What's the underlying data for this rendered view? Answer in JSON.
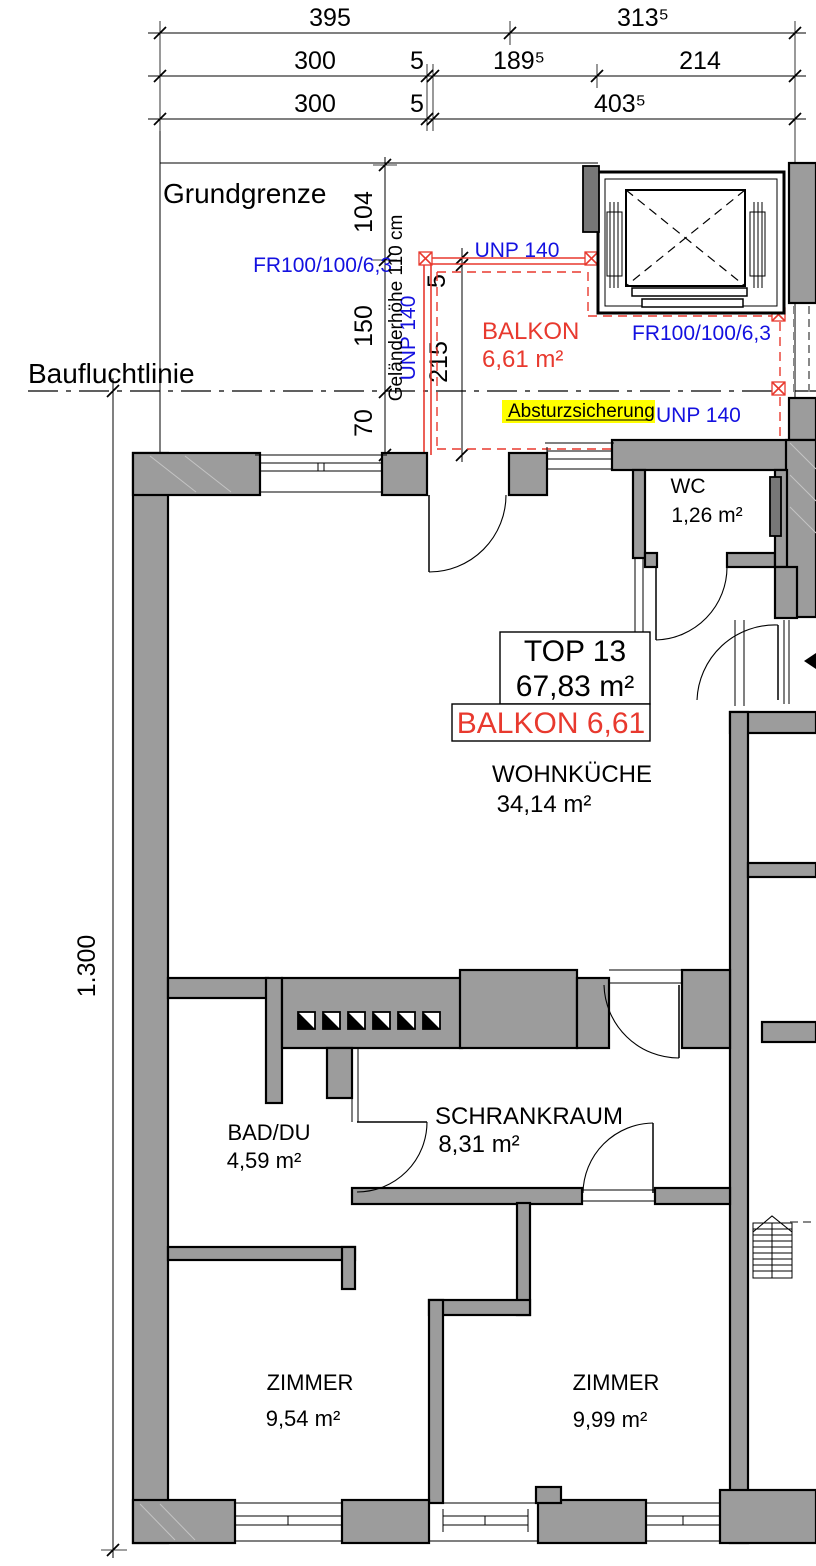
{
  "labels": {
    "grundgrenze": "Grundgrenze",
    "baufluchtlinie": "Baufluchtlinie"
  },
  "dimensions": {
    "top_rows": [
      {
        "segments": [
          "395",
          "313⁵"
        ]
      },
      {
        "segments": [
          "300",
          "5",
          "189⁵",
          "214"
        ]
      },
      {
        "segments": [
          "300",
          "5",
          "403⁵"
        ]
      }
    ],
    "left_vertical": "1.300",
    "right_chain": [
      "104",
      "150",
      "70"
    ],
    "balcony_chain": [
      "5",
      "215"
    ]
  },
  "balcony": {
    "name": "BALKON",
    "area": "6,61 m²",
    "rail_note": "Geländerhöhe 110 cm",
    "unp_top": "UNP 140",
    "unp_left": "UNP 140",
    "unp_bottom": "UNP 140",
    "fr_left": "FR100/100/6,3",
    "fr_right": "FR100/100/6,3",
    "guard": "Absturzsicherung"
  },
  "unit": {
    "id": "TOP 13",
    "area": "67,83 m²",
    "balcony_line": "BALKON 6,61"
  },
  "rooms": {
    "wohnkueche": {
      "name": "WOHNKÜCHE",
      "area": "34,14 m²"
    },
    "wc": {
      "name": "WC",
      "area": "1,26 m²"
    },
    "bad": {
      "name": "BAD/DU",
      "area": "4,59 m²"
    },
    "schrankraum": {
      "name": "SCHRANKRAUM",
      "area": "8,31 m²"
    },
    "zimmer_left": {
      "name": "ZIMMER",
      "area": "9,54 m²"
    },
    "zimmer_right": {
      "name": "ZIMMER",
      "area": "9,99 m²"
    }
  },
  "colors": {
    "wall": "#9c9c9c",
    "red": "#e8392e",
    "blue": "#1411e0",
    "highlight": "#ffff00"
  }
}
